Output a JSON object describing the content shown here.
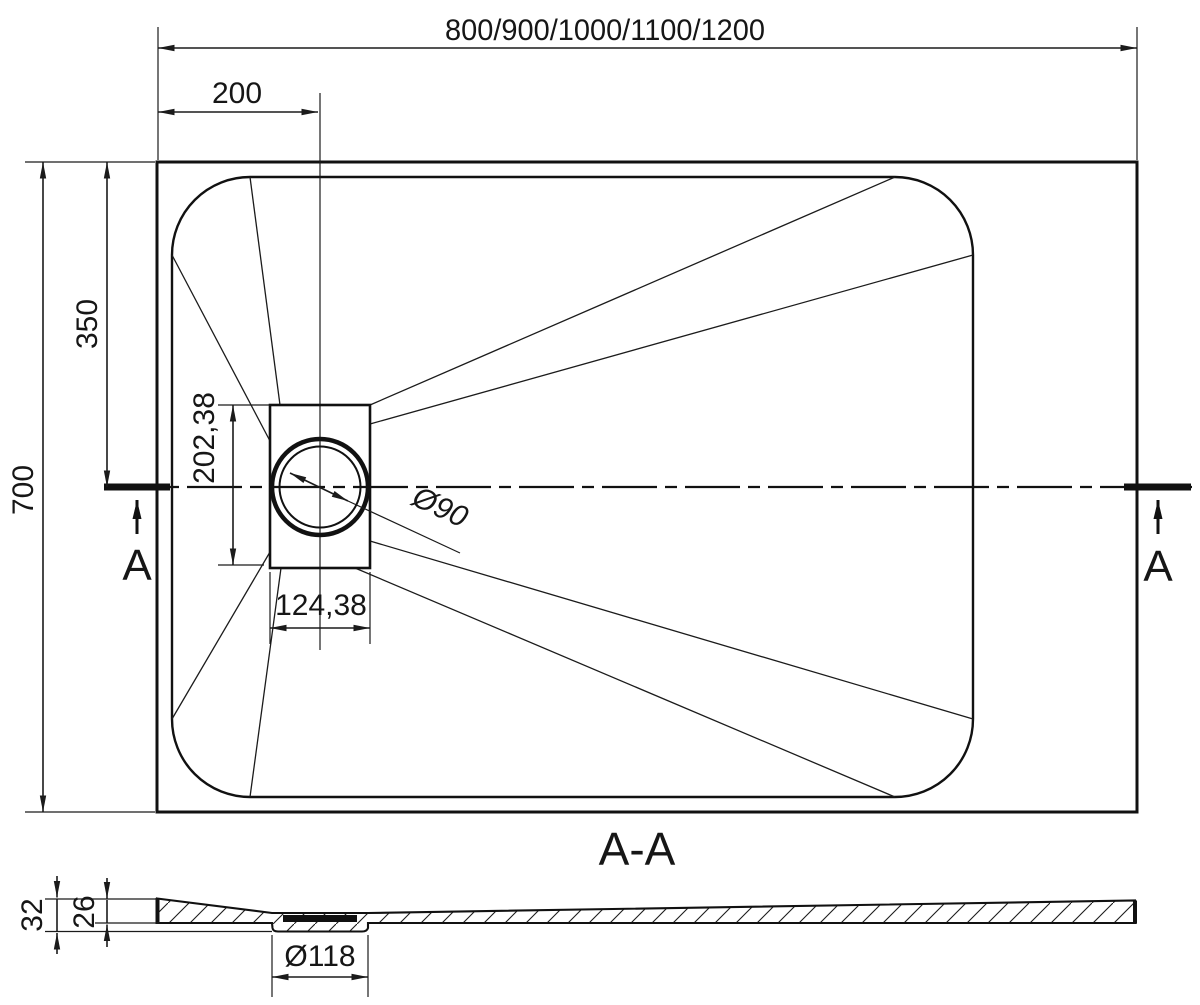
{
  "drawing": {
    "top_dimension": "800/900/1000/1100/1200",
    "drain_offset_horizontal": "200",
    "drain_offset_vertical": "350",
    "tray_depth": "700",
    "cutout_height": "202,38",
    "cutout_width": "124,38",
    "drain_diameter": "Ø90",
    "section_marker": "A",
    "section_title": "A-A",
    "overall_height": "32",
    "base_thickness": "26",
    "recess_diameter": "Ø118",
    "colors": {
      "line": "#1b1b1b",
      "background": "#ffffff"
    }
  }
}
